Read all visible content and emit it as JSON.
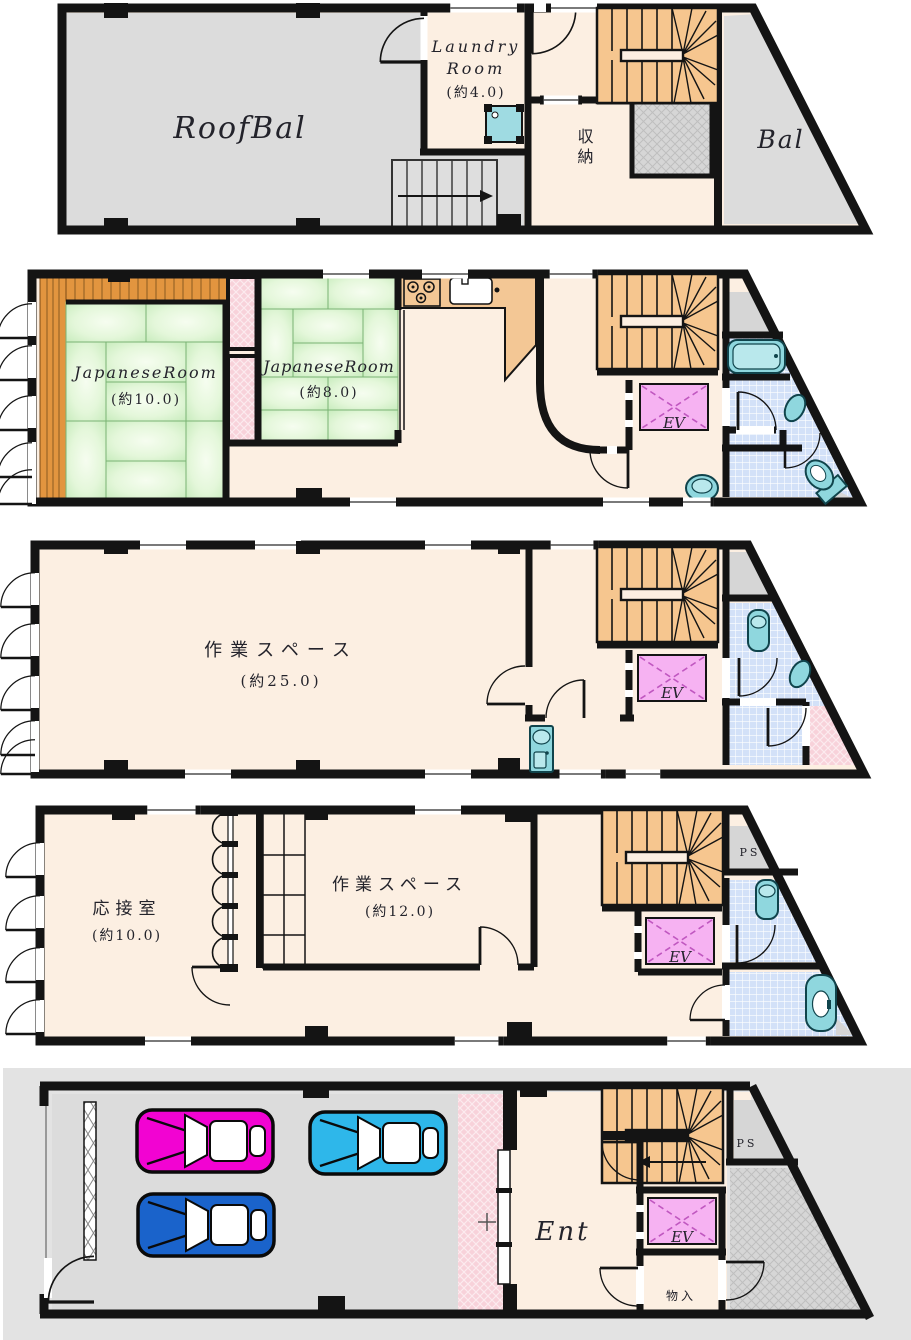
{
  "elevator_label": "EV",
  "floors": {
    "roof": {
      "roofbal": "RoofBal",
      "laundry_line1": "Laundry",
      "laundry_line2": "Room",
      "laundry_size": "(約4.0)",
      "storage": "収納",
      "bal": "Bal"
    },
    "f4": {
      "jp_room_large": "JapaneseRoom",
      "jp_room_large_size": "(約10.0)",
      "jp_room_small": "JapaneseRoom",
      "jp_room_small_size": "(約8.0)"
    },
    "f3": {
      "workspace": "作業スペース",
      "workspace_size": "(約25.0)"
    },
    "f2": {
      "reception": "応接室",
      "reception_size": "(約10.0)",
      "workspace": "作業スペース",
      "workspace_size": "(約12.0)",
      "pipe_space": "PS"
    },
    "f1": {
      "entrance": "Ent",
      "closet": "物入",
      "pipe_space": "PS"
    }
  },
  "colors": {
    "wall": "#141414",
    "floor_cream": "#fcefe2",
    "balcony_gray": "#dcdcdc",
    "stair_orange": "#f6c68f",
    "veranda_orange": "#e2953f",
    "counter_orange": "#f3c795",
    "tatami_green": "#d9f2cf",
    "closet_pink": "#f8d2da",
    "elevator_pink": "#f6b2f2",
    "tile_blue": "#d3e1f8",
    "fixture_teal": "#8fd7de",
    "approach_pink": "#f8d0d8",
    "car_magenta": "#f203d2",
    "car_cyan": "#2eb7ea",
    "car_blue": "#1a63cb",
    "ground_gray": "#e3e3e3"
  }
}
